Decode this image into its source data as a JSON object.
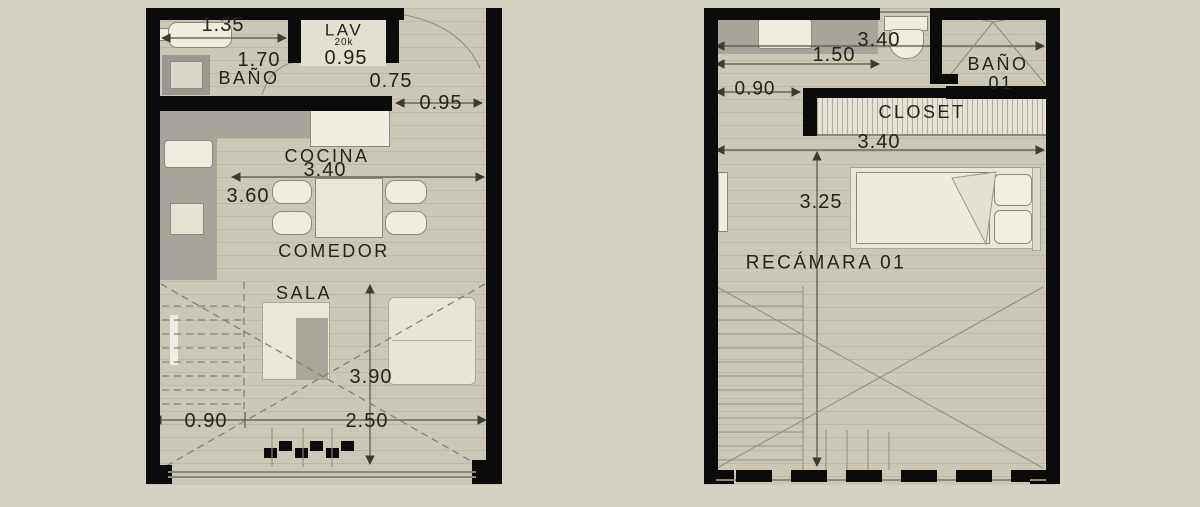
{
  "title": "Two-level apartment floor plans",
  "colors": {
    "background": "#d4d1c5",
    "floor": "#cbc8b8",
    "wall": "#0b0b0b",
    "counter_gray": "#a7a59b",
    "fixture_white": "#efede0",
    "dimension_line": "#4d4b42"
  },
  "plans": {
    "left": {
      "name": "planta baja",
      "labels": {
        "dim_135": "1.35",
        "lav": "LAV",
        "lav_capacity": "20k",
        "dim_170": "1.70",
        "dim_095_lav": "0.95",
        "banio": "BAÑO",
        "dim_075": "0.75",
        "dim_095_door": "0.95",
        "cocina": "COCINA",
        "dim_340": "3.40",
        "dim_360": "3.60",
        "comedor": "COMEDOR",
        "sala": "SALA",
        "dim_390": "3.90",
        "dim_090": "0.90",
        "dim_250": "2.50"
      }
    },
    "right": {
      "name": "planta alta",
      "labels": {
        "dim_340_top": "3.40",
        "dim_150": "1.50",
        "banio_line1": "BAÑO",
        "banio_line2": "01",
        "dim_090": "0.90",
        "closet": "CLOSET",
        "dim_340_mid": "3.40",
        "dim_325": "3.25",
        "recamara": "RECÁMARA 01"
      }
    }
  }
}
